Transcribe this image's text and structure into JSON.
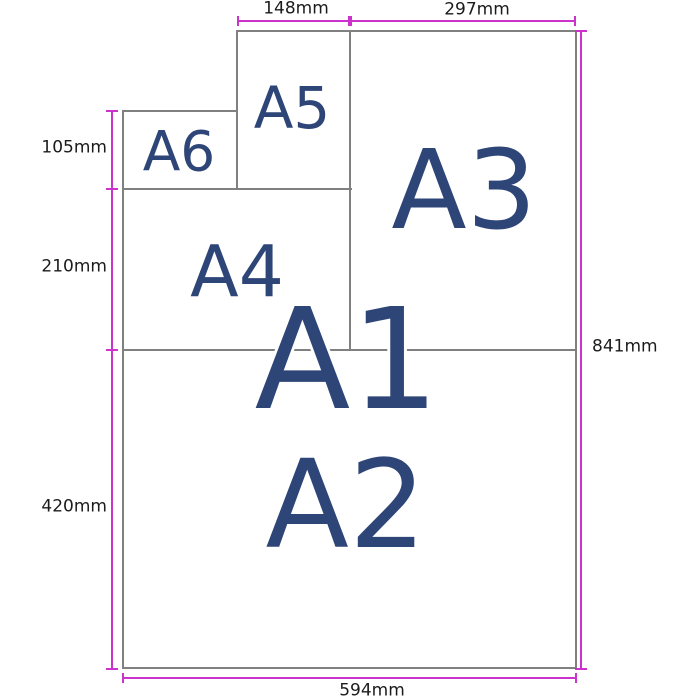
{
  "diagram": {
    "description": "Paper size comparison diagram showing A1-A6 sheets nested with dimension annotations",
    "paper_labels": {
      "a1": "A1",
      "a2": "A2",
      "a3": "A3",
      "a4": "A4",
      "a5": "A5",
      "a6": "A6"
    },
    "dimensions": {
      "top_left_width": "148mm",
      "top_right_width": "297mm",
      "left_upper_height": "105mm",
      "left_middle_height": "210mm",
      "left_lower_height": "420mm",
      "right_height": "841mm",
      "bottom_width": "594mm"
    },
    "colors": {
      "magenta": "#cc33cc",
      "border-gray": "#808080",
      "label-navy": "#2e4578",
      "dim-text": "#1b1b1b",
      "background": "#ffffff"
    }
  }
}
